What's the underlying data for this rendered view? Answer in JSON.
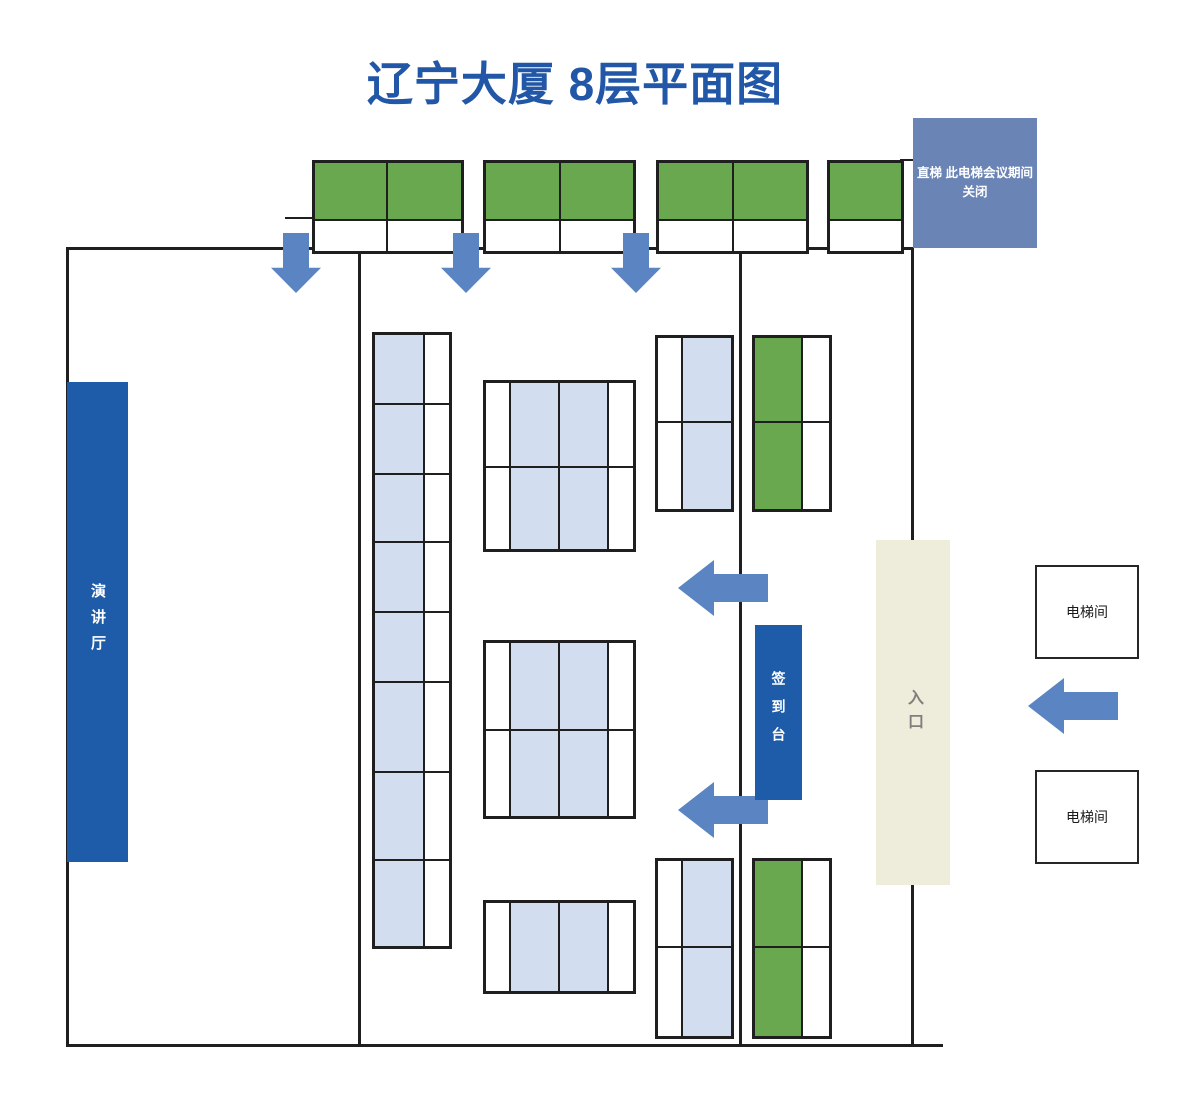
{
  "title": "辽宁大厦 8层平面图",
  "colors": {
    "title": "#2157A6",
    "dark_blue": "#1E5BA9",
    "steel_blue": "#6A84B6",
    "arrow_blue": "#5B84C2",
    "green": "#6AA84F",
    "lightblue": "#D2DEF0",
    "white": "#ffffff",
    "beige": "#EEEDDC",
    "wall": "#1f1f1f",
    "entrance_text": "#7f7f7f"
  },
  "boxes": {
    "elevator_notice": {
      "line1": "直梯 此电梯会议期间",
      "line2": "关闭"
    },
    "lecture_hall": {
      "label": "演讲厅"
    },
    "sign_in_desk": {
      "label": "签到台"
    },
    "entrance": {
      "label": "入口"
    },
    "elevator_room_top": {
      "label": "电梯间"
    },
    "elevator_room_bottom": {
      "label": "电梯间"
    }
  },
  "walls": [
    {
      "name": "wall-left",
      "x": 66,
      "y": 247,
      "w": 3,
      "h": 800
    },
    {
      "name": "wall-top",
      "x": 66,
      "y": 247,
      "w": 848,
      "h": 3
    },
    {
      "name": "wall-right",
      "x": 911,
      "y": 247,
      "w": 3,
      "h": 800
    },
    {
      "name": "wall-bottom",
      "x": 66,
      "y": 1044,
      "w": 877,
      "h": 3
    },
    {
      "name": "wall-mid-left",
      "x": 358,
      "y": 247,
      "w": 3,
      "h": 800
    },
    {
      "name": "wall-mid-right",
      "x": 739,
      "y": 247,
      "w": 3,
      "h": 800
    },
    {
      "name": "wall-stub-left",
      "x": 285,
      "y": 217,
      "w": 27,
      "h": 2
    },
    {
      "name": "wall-stub-top-right",
      "x": 900,
      "y": 159,
      "w": 13,
      "h": 2
    }
  ],
  "grids": [
    {
      "name": "corridor-table-group-1",
      "x": 312,
      "y": 160,
      "col_widths": [
        73,
        75
      ],
      "col_fills": [
        "green",
        "green"
      ],
      "row_heights": [
        58,
        32
      ],
      "row_white": [
        false,
        true
      ]
    },
    {
      "name": "corridor-table-group-2",
      "x": 483,
      "y": 160,
      "col_widths": [
        75,
        74
      ],
      "col_fills": [
        "green",
        "green"
      ],
      "row_heights": [
        58,
        32
      ],
      "row_white": [
        false,
        true
      ]
    },
    {
      "name": "corridor-table-group-3",
      "x": 656,
      "y": 160,
      "col_widths": [
        75,
        74
      ],
      "col_fills": [
        "green",
        "green"
      ],
      "row_heights": [
        58,
        32
      ],
      "row_white": [
        false,
        true
      ]
    },
    {
      "name": "corridor-table-group-4",
      "x": 827,
      "y": 160,
      "col_widths": [
        73
      ],
      "col_fills": [
        "green"
      ],
      "row_heights": [
        58,
        32
      ],
      "row_white": [
        false,
        true
      ]
    },
    {
      "name": "long-table-left",
      "x": 372,
      "y": 332,
      "col_widths": [
        50,
        26
      ],
      "col_fills": [
        "lightblue",
        "white"
      ],
      "row_heights": [
        70,
        70,
        68,
        70,
        70,
        90,
        88,
        87
      ]
    },
    {
      "name": "center-table-1",
      "x": 483,
      "y": 380,
      "col_widths": [
        25,
        49,
        49,
        26
      ],
      "col_fills": [
        "white",
        "lightblue",
        "lightblue",
        "white"
      ],
      "row_heights": [
        85,
        83
      ]
    },
    {
      "name": "center-table-2",
      "x": 483,
      "y": 640,
      "col_widths": [
        25,
        49,
        49,
        26
      ],
      "col_fills": [
        "white",
        "lightblue",
        "lightblue",
        "white"
      ],
      "row_heights": [
        88,
        87
      ]
    },
    {
      "name": "center-table-3",
      "x": 483,
      "y": 900,
      "col_widths": [
        25,
        49,
        49,
        26
      ],
      "col_fills": [
        "white",
        "lightblue",
        "lightblue",
        "white"
      ],
      "row_heights": [
        90
      ]
    },
    {
      "name": "right-table-top",
      "x": 655,
      "y": 335,
      "col_widths": [
        25,
        50
      ],
      "col_fills": [
        "white",
        "lightblue"
      ],
      "row_heights": [
        85,
        88
      ]
    },
    {
      "name": "right-table-bottom",
      "x": 655,
      "y": 858,
      "col_widths": [
        25,
        50
      ],
      "col_fills": [
        "white",
        "lightblue"
      ],
      "row_heights": [
        87,
        90
      ]
    },
    {
      "name": "green-table-top",
      "x": 752,
      "y": 335,
      "col_widths": [
        48,
        28
      ],
      "col_fills": [
        "green",
        "white"
      ],
      "row_heights": [
        85,
        88
      ]
    },
    {
      "name": "green-table-bottom",
      "x": 752,
      "y": 858,
      "col_widths": [
        48,
        28
      ],
      "col_fills": [
        "green",
        "white"
      ],
      "row_heights": [
        87,
        90
      ]
    }
  ],
  "arrows": [
    {
      "name": "arrow-down-1",
      "dir": "down",
      "x": 271,
      "y": 233,
      "w": 50,
      "h": 60
    },
    {
      "name": "arrow-down-2",
      "dir": "down",
      "x": 441,
      "y": 233,
      "w": 50,
      "h": 60
    },
    {
      "name": "arrow-down-3",
      "dir": "down",
      "x": 611,
      "y": 233,
      "w": 50,
      "h": 60
    },
    {
      "name": "arrow-left-top",
      "dir": "left",
      "x": 678,
      "y": 560,
      "w": 90,
      "h": 56
    },
    {
      "name": "arrow-left-bottom",
      "dir": "left",
      "x": 678,
      "y": 782,
      "w": 90,
      "h": 56
    },
    {
      "name": "arrow-left-entrance",
      "dir": "left",
      "x": 1028,
      "y": 678,
      "w": 90,
      "h": 56
    }
  ]
}
